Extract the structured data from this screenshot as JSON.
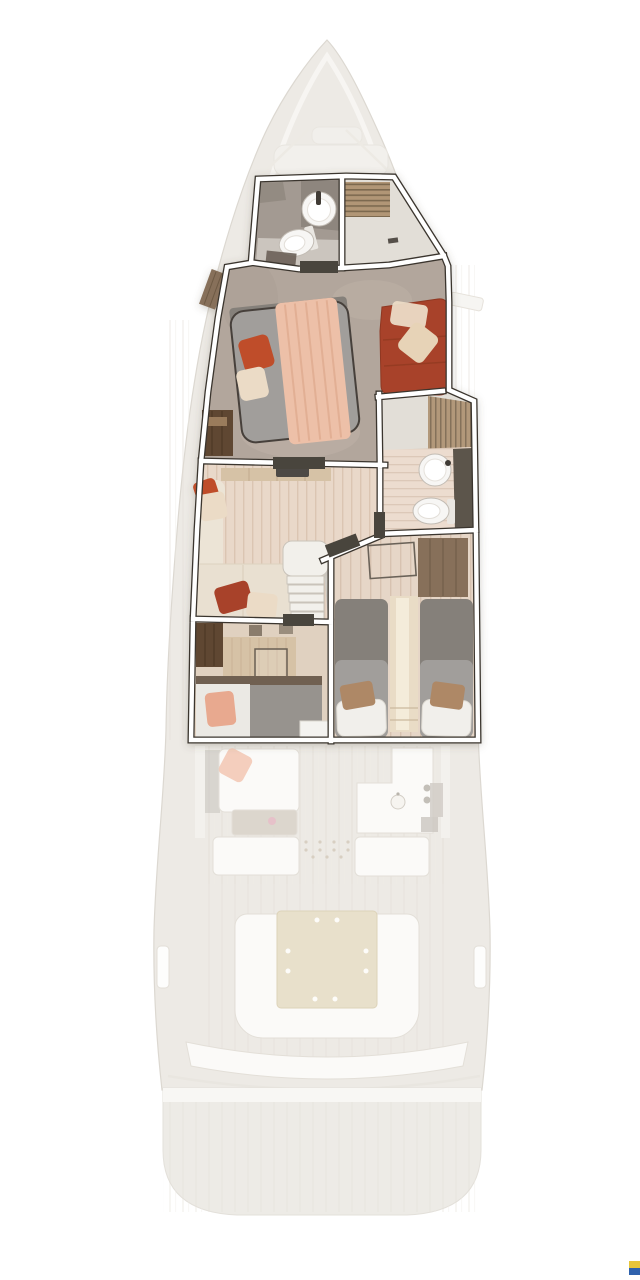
{
  "figure": {
    "type": "yacht-floor-plan-rendering",
    "view": "top-down",
    "highlighted_deck": "lower-deck-cabins",
    "ghosted_deck": "main-deck"
  },
  "areas": [
    "forward-bathroom",
    "forward-shower",
    "owner-cabin",
    "midship-bathroom",
    "lounge",
    "twin-guest-cabin",
    "guest-cabin",
    "salon",
    "galley",
    "cockpit",
    "swim-platform"
  ],
  "palette": {
    "hull": "#edeae5",
    "hull_line": "#dcd8d1",
    "gunwale": "#f7f6f3",
    "wall_line": "#3a352e",
    "threshold": "#4a443c",
    "master_floor": "#b2a69c",
    "bath_floor": "#a39a92",
    "bath_floor_light": "#cfcac3",
    "bath_counter": "#8e867e",
    "shower_floor": "#e2ded7",
    "shower_slat": "#b19676",
    "shower_slat_line": "#7c6950",
    "slat2": "#b2987a",
    "slat2_line": "#84715a",
    "lounge_floor": "#e9d8c9",
    "lounge_plank": "#dbc5b2",
    "bath2_floor": "#ecdccf",
    "bath2_plank": "#dcc8b8",
    "twin_floor": "#e6d6c7",
    "twin_plank": "#d7c2b0",
    "guest_floor": "#e0d1c0",
    "mattress": "#a19e9b",
    "mattress_dark": "#85807a",
    "blanket": "#edc0a8",
    "blanket_fold": "#d9a183",
    "pillow_orange": "#bf4e29",
    "pillow_cream": "#ebdbc6",
    "terracotta": "#a8432a",
    "terracotta_dark": "#8f3722",
    "pillow_tan": "#ae8866",
    "pillow_white": "#f1efeb",
    "salmon": "#e8a98f",
    "wood_dark": "#5e4632",
    "wood_mid": "#87705a",
    "wood_light": "#d6c2a6",
    "counter_dark": "#5c544b",
    "fixture_white": "#f7f6f4",
    "fixture_line": "#c2bcb4",
    "tv_dark": "#4e4944",
    "stair_white": "#f2f0eb",
    "stair_line": "#c9c3ba",
    "dresser_line": "#c2ab8e",
    "sofa_beige": "#ece4d6",
    "sofa_seat": "#e9e0d1",
    "sofa_stroke": "#ddd2c0",
    "ghost_white": "#fbfaf8",
    "ghost_line": "#e3dfd8",
    "ghost_wood_line": "#e4e0d8",
    "ghost_dark": "#c7c3bd",
    "ghost_table": "#dcd6cd",
    "ghost_salmon": "#f3c9b6",
    "table_beige": "#e8e0cb",
    "table_line": "#ddd3b9",
    "platform": "#edebe6",
    "platform_band": "#f8f7f4",
    "flag_yellow": "#e7c53a",
    "flag_blue": "#2f62ad"
  }
}
